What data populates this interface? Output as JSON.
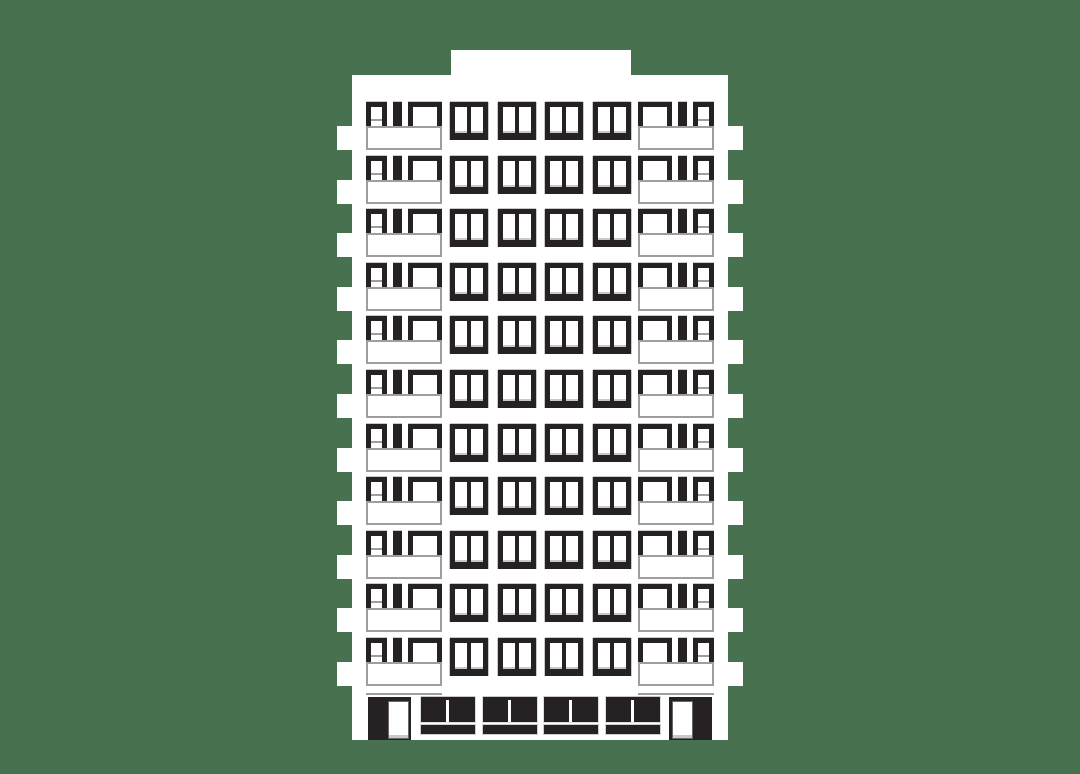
{
  "scene": {
    "kind": "flat-vector illustration",
    "subject": "high-rise panel apartment building, front elevation, white facade with black windows on a green background"
  },
  "palette": {
    "background": "#48714F",
    "facade": "#FFFFFF",
    "window_ink": "#262223",
    "outline_gray": "#9E9E9E",
    "sill_gray": "#C9C9C9"
  },
  "building": {
    "floors": 11,
    "middle_windows_per_floor": 4,
    "balcony_units_per_floor": 2,
    "side_balconies_per_side": 11,
    "rooftop_structures": 1,
    "ground_floor": {
      "entrance_doors": 2,
      "storefronts": 4
    }
  }
}
